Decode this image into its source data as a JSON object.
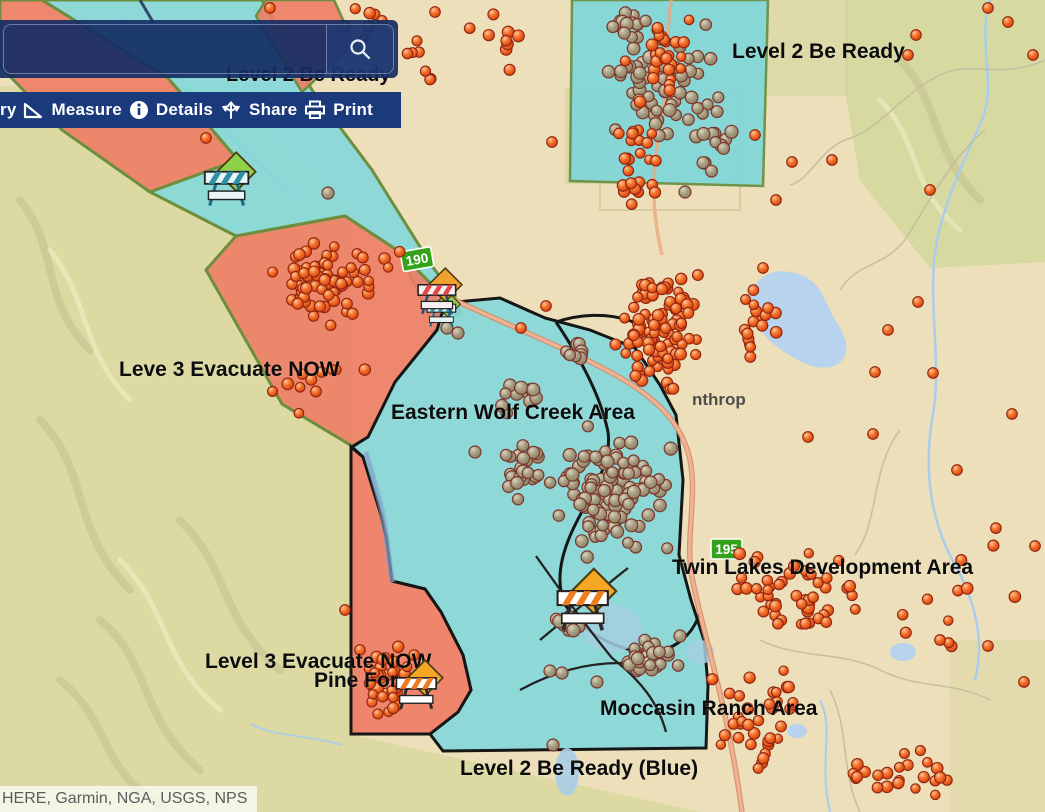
{
  "search": {
    "value": "",
    "placeholder": ""
  },
  "toolbar": {
    "items": [
      {
        "label": "ry",
        "icon": null
      },
      {
        "label": "Measure",
        "icon": "measure-icon"
      },
      {
        "label": "Details",
        "icon": "info-icon"
      },
      {
        "label": "Share",
        "icon": "share-icon"
      },
      {
        "label": "Print",
        "icon": "print-icon"
      }
    ]
  },
  "attribution": "HERE, Garmin, NGA, USGS, NPS",
  "colors": {
    "toolbar_navy": "#1b3a7c",
    "panel_navy": "#132c63",
    "zone_red": "#ef7b64",
    "zone_blue": "#84d8dc",
    "zone_border_green": "#6d8f3d",
    "zone_border_black": "#161616",
    "dot_orange": "#f05a22",
    "dot_gray": "#a59c80",
    "shield_green": "#33a31c",
    "highway_salmon": "#eda77f"
  },
  "map": {
    "town_label": {
      "text": "nthrop",
      "x": 692,
      "y": 405
    },
    "route_shields": [
      {
        "text": "190",
        "x": 400,
        "y": 252,
        "rot": -10
      },
      {
        "text": "195",
        "x": 711,
        "y": 539,
        "rot": 0
      }
    ],
    "zone_labels": [
      {
        "id": "l2-ready-topleft",
        "text": "Level 2 Be Ready",
        "x": 226,
        "y": 64,
        "size": 20
      },
      {
        "id": "l2-ready-topright",
        "text": "Level 2 Be Ready",
        "x": 732,
        "y": 40,
        "size": 21
      },
      {
        "id": "l3-evacuate-left",
        "text": "Leve 3 Evacuate NOW",
        "x": 119,
        "y": 358,
        "size": 21
      },
      {
        "id": "eastern-wolf-creek",
        "text": "Eastern Wolf Creek Area",
        "x": 391,
        "y": 401,
        "size": 21
      },
      {
        "id": "twin-lakes",
        "text": "Twin Lakes Development Area",
        "x": 672,
        "y": 556,
        "size": 21
      },
      {
        "id": "moccasin-ranch",
        "text": "Moccasin Ranch Area",
        "x": 600,
        "y": 697,
        "size": 21
      },
      {
        "id": "l2-ready-blue",
        "text": "Level 2 Be Ready (Blue)",
        "x": 460,
        "y": 757,
        "size": 21
      },
      {
        "id": "l3-pine-line1",
        "text": "Level 3 Evacuate NOW",
        "x": 205,
        "y": 650,
        "size": 21
      },
      {
        "id": "l3-pine-line2",
        "text": "Pine For",
        "x": 314,
        "y": 669,
        "size": 21
      }
    ],
    "markers": [
      {
        "name": "road-closure-barrier",
        "variant": "teal",
        "x": 200,
        "y": 150,
        "s": 1.2
      },
      {
        "name": "road-closure-barrier",
        "variant": "teal",
        "x": 424,
        "y": 290,
        "s": 0.8
      },
      {
        "name": "road-closure-barrier",
        "variant": "red",
        "x": 414,
        "y": 266,
        "s": 1.05
      },
      {
        "name": "road-closure-barrier",
        "variant": "orange",
        "x": 552,
        "y": 566,
        "s": 1.4
      },
      {
        "name": "road-closure-barrier",
        "variant": "orange",
        "x": 392,
        "y": 658,
        "s": 1.1
      }
    ],
    "dot_layers": {
      "gray_clusters": [
        {
          "cx": 668,
          "cy": 88,
          "rx": 80,
          "ry": 85,
          "n": 62,
          "seed": 11
        },
        {
          "cx": 630,
          "cy": 28,
          "rx": 26,
          "ry": 26,
          "n": 16,
          "seed": 12
        },
        {
          "cx": 612,
          "cy": 492,
          "rx": 72,
          "ry": 70,
          "n": 125,
          "seed": 13
        },
        {
          "cx": 521,
          "cy": 470,
          "rx": 28,
          "ry": 42,
          "n": 22,
          "seed": 14
        },
        {
          "cx": 527,
          "cy": 396,
          "rx": 34,
          "ry": 20,
          "n": 13,
          "seed": 15
        },
        {
          "cx": 577,
          "cy": 352,
          "rx": 26,
          "ry": 16,
          "n": 9,
          "seed": 16
        },
        {
          "cx": 651,
          "cy": 660,
          "rx": 52,
          "ry": 28,
          "n": 30,
          "seed": 17
        },
        {
          "cx": 566,
          "cy": 624,
          "rx": 24,
          "ry": 18,
          "n": 10,
          "seed": 18
        },
        {
          "cx": 718,
          "cy": 148,
          "rx": 30,
          "ry": 40,
          "n": 12,
          "seed": 19
        }
      ],
      "gray_singles": [
        [
          328,
          193
        ],
        [
          685,
          192
        ],
        [
          447,
          328
        ],
        [
          458,
          333
        ],
        [
          553,
          745
        ],
        [
          550,
          671
        ],
        [
          562,
          673
        ],
        [
          597,
          682
        ],
        [
          680,
          636
        ],
        [
          475,
          452
        ]
      ],
      "orange_clusters": [
        {
          "cx": 664,
          "cy": 58,
          "rx": 44,
          "ry": 68,
          "n": 26,
          "seed": 21
        },
        {
          "cx": 640,
          "cy": 172,
          "rx": 42,
          "ry": 58,
          "n": 24,
          "seed": 22
        },
        {
          "cx": 497,
          "cy": 44,
          "rx": 58,
          "ry": 36,
          "n": 9,
          "seed": 23
        },
        {
          "cx": 352,
          "cy": 22,
          "rx": 55,
          "ry": 26,
          "n": 8,
          "seed": 24
        },
        {
          "cx": 658,
          "cy": 330,
          "rx": 52,
          "ry": 82,
          "n": 105,
          "seed": 25
        },
        {
          "cx": 752,
          "cy": 325,
          "rx": 38,
          "ry": 55,
          "n": 16,
          "seed": 26
        },
        {
          "cx": 330,
          "cy": 282,
          "rx": 82,
          "ry": 58,
          "n": 80,
          "seed": 27
        },
        {
          "cx": 300,
          "cy": 378,
          "rx": 88,
          "ry": 46,
          "n": 11,
          "seed": 28
        },
        {
          "cx": 790,
          "cy": 598,
          "rx": 88,
          "ry": 58,
          "n": 50,
          "seed": 29
        },
        {
          "cx": 758,
          "cy": 718,
          "rx": 66,
          "ry": 64,
          "n": 38,
          "seed": 30
        },
        {
          "cx": 888,
          "cy": 778,
          "rx": 78,
          "ry": 34,
          "n": 24,
          "seed": 31
        },
        {
          "cx": 952,
          "cy": 598,
          "rx": 88,
          "ry": 88,
          "n": 12,
          "seed": 32
        },
        {
          "cx": 386,
          "cy": 678,
          "rx": 33,
          "ry": 46,
          "n": 36,
          "seed": 33
        },
        {
          "cx": 418,
          "cy": 58,
          "rx": 36,
          "ry": 40,
          "n": 7,
          "seed": 34
        }
      ],
      "orange_singles": [
        [
          875,
          372
        ],
        [
          933,
          373
        ],
        [
          918,
          302
        ],
        [
          1012,
          414
        ],
        [
          957,
          470
        ],
        [
          873,
          434
        ],
        [
          1035,
          546
        ],
        [
          988,
          646
        ],
        [
          940,
          640
        ],
        [
          1024,
          682
        ],
        [
          916,
          35
        ],
        [
          1008,
          22
        ],
        [
          1033,
          55
        ],
        [
          988,
          8
        ],
        [
          435,
          12
        ],
        [
          270,
          8
        ],
        [
          206,
          138
        ],
        [
          552,
          142
        ],
        [
          908,
          55
        ],
        [
          930,
          190
        ],
        [
          755,
          135
        ],
        [
          792,
          162
        ],
        [
          776,
          200
        ],
        [
          832,
          160
        ],
        [
          763,
          268
        ],
        [
          768,
          308
        ],
        [
          888,
          330
        ],
        [
          808,
          437
        ],
        [
          521,
          328
        ],
        [
          546,
          306
        ],
        [
          360,
          650
        ],
        [
          345,
          610
        ]
      ]
    }
  }
}
